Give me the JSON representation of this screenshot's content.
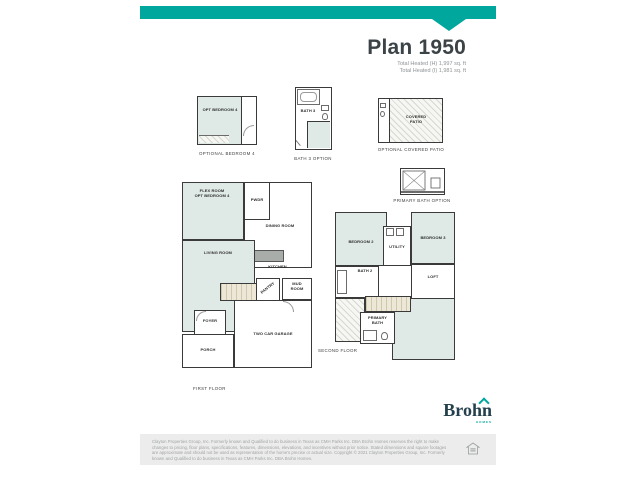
{
  "colors": {
    "brand_teal": "#00a79d",
    "title_dark": "#3c4347",
    "logo_navy": "#24404d",
    "room_fill": "#dfe9e6",
    "footer_bg": "#ebeceb"
  },
  "header": {
    "title": "Plan 1950",
    "stat_line_1": "Total Heated (H) 1,997 sq. ft",
    "stat_line_2": "Total Heated (I) 1,981 sq. ft"
  },
  "options": {
    "bedroom4": {
      "room_label": "OPT BEDROOM 4",
      "caption": "OPTIONAL BEDROOM 4"
    },
    "bath3": {
      "room_label": "BATH 3",
      "caption": "BATH 3 OPTION"
    },
    "patio": {
      "room_label": "COVERED\nPATIO",
      "caption": "OPTIONAL COVERED PATIO"
    },
    "primary_bath": {
      "caption": "PRIMARY BATH OPTION"
    }
  },
  "first_floor": {
    "caption": "FIRST FLOOR",
    "rooms": {
      "flex": "FLEX ROOM\nOPT BEDROOM 4",
      "pwdr": "PWDR",
      "dining": "DINING ROOM",
      "living": "LIVING ROOM",
      "kitchen": "KITCHEN",
      "pantry": "PANTRY",
      "mud": "MUD\nROOM",
      "foyer": "FOYER",
      "porch": "PORCH",
      "garage": "TWO CAR GARAGE"
    }
  },
  "second_floor": {
    "caption": "SECOND FLOOR",
    "rooms": {
      "bedroom2": "BEDROOM 2",
      "bedroom3": "BEDROOM 3",
      "utility": "UTILITY",
      "bath2": "BATH 2",
      "loft": "LOFT",
      "primary_bath": "PRIMARY\nBATH"
    }
  },
  "logo": {
    "name": "Brohn",
    "tagline": "HOMES"
  },
  "footer": {
    "disclaimer": "Clayton Properties Group, Inc. Formerly known and Qualified to do business in Texas as CMH Parks Inc. DBA Brohn Homes reserves the right to make changes to pricing, floor plans, specifications, features, dimensions, elevations, and incentives without prior notice. Stated dimensions and square footages are approximate and should not be used as representation of the home's precise or actual size. Copyright © 2021 Clayton Properties Group, Inc. Formerly known and Qualified to do business in Texas as CMH Parks Inc. DBA Brohn Homes."
  }
}
